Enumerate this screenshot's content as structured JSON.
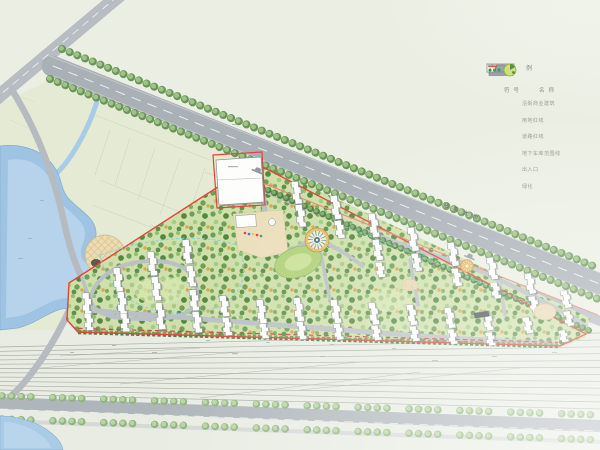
{
  "legend": {
    "title": "图例",
    "col_symbol": "符号",
    "col_name": "名称",
    "items": [
      {
        "symbol": "building-outline-box",
        "label": "沿街商业建筑",
        "color": "#ffffff"
      },
      {
        "symbol": "thick-red-line",
        "label": "用地红线",
        "color": "#e8564a"
      },
      {
        "symbol": "thin-red-line",
        "label": "道路红线",
        "color": "#ef8b7c"
      },
      {
        "symbol": "cyan-dashed-line",
        "label": "地下车库范围线",
        "color": "#7ccfe0"
      },
      {
        "symbol": "gate-icon",
        "label": "出入口",
        "color": "#99a1a9"
      },
      {
        "symbol": "tree-icon",
        "label": "绿化",
        "color": "#9fc84f"
      }
    ]
  },
  "map": {
    "road_label": "站前大街",
    "colors": {
      "background": "#ebefe3",
      "village_ground": "#e5ead4",
      "water": "#a9cbe6",
      "road_gray": "#a9b0b6",
      "canopy_base": "#cfe0ac",
      "site_boundary_red": "#e0453a",
      "road_red_line": "#ef8376",
      "garage_line_cyan": "#7ccfe0",
      "tree_dark": "#6a9459",
      "tree_light": "#9fc285"
    }
  }
}
